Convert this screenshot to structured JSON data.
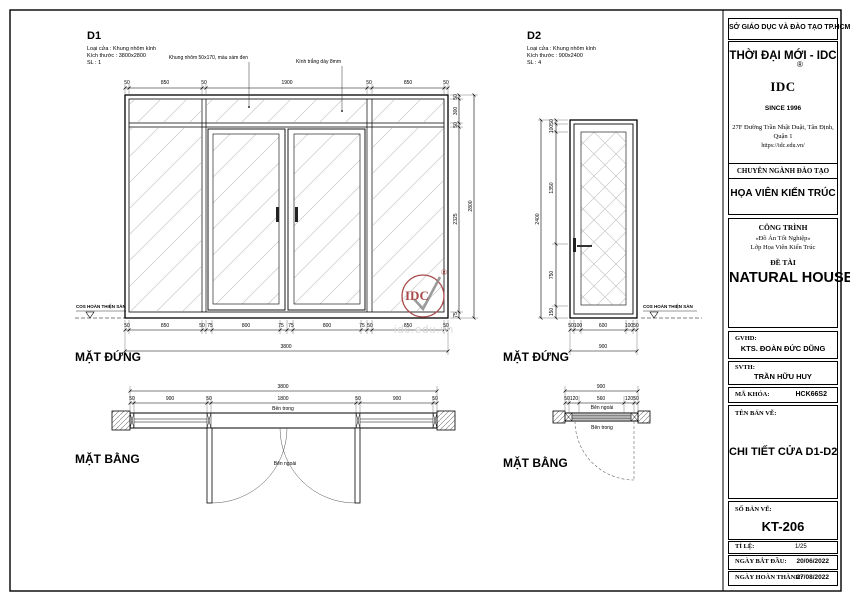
{
  "colors": {
    "stamp": "#a84a4a",
    "watermark": "#d9d9d9",
    "hatch": "#c8c8c8"
  },
  "watermark": "idc.edu.vn",
  "stamp": {
    "text": "IDC",
    "registered": "®"
  },
  "d1": {
    "code": "D1",
    "meta_type": "Loại cửa : Khung nhôm kính",
    "meta_size": "Kích thước : 3800x2800",
    "meta_qty": "SL : 1",
    "ann_frame": "Khung nhôm 50x170, màu xám đen",
    "ann_glass": "Kính trắng dày 8mm",
    "elevation_label": "MẶT ĐỨNG",
    "plan_label": "MẶT BẰNG",
    "floor_label": "COS HOÀN THIỆN SÀN",
    "inside": "Bên trong",
    "outside": "Bên ngoài",
    "dims": {
      "top": [
        "50",
        "850",
        "50",
        "1900",
        "50",
        "850",
        "50"
      ],
      "right": [
        "50",
        "300",
        "50",
        "2325",
        "75"
      ],
      "right_total": "2800",
      "bottom": [
        "50",
        "850",
        "50",
        "75",
        "800",
        "75",
        "75",
        "800",
        "75",
        "50",
        "850",
        "50"
      ],
      "bottom_total": "3800",
      "plan": [
        "50",
        "900",
        "50",
        "1800",
        "50",
        "900",
        "50"
      ],
      "plan_total": "3800"
    }
  },
  "d2": {
    "code": "D2",
    "meta_type": "Loại cửa : Khung nhôm kính",
    "meta_size": "Kích thước : 900x2400",
    "meta_qty": "SL : 4",
    "elevation_label": "MẶT ĐỨNG",
    "plan_label": "MẶT BẰNG",
    "floor_label": "COS HOÀN THIỆN SÀN",
    "inside": "Bên trong",
    "outside": "Bên ngoài",
    "dims": {
      "left": [
        "50",
        "100",
        "1350",
        "750",
        "150"
      ],
      "left_total": "2400",
      "bottom": [
        "50",
        "100",
        "600",
        "100",
        "50"
      ],
      "bottom_total": "900",
      "plan": [
        "50",
        "120",
        "560",
        "120",
        "50"
      ],
      "plan_total": "900"
    }
  },
  "titleblock": {
    "agency": "SỞ GIÁO DỤC VÀ ĐÀO TẠO TP.HCM",
    "brand": "THỜI ĐẠI MỚI - IDC",
    "logo_text": "IDC",
    "registered": "®",
    "since": "SINCE 1996",
    "address": "27F Đường Trần Nhật Duật, Tân Định,",
    "address2": "Quận 1",
    "website": "https://idc.edu.vn/",
    "training_header": "CHUYÊN NGÀNH ĐÀO TẠO",
    "major": "HỌA VIÊN KIẾN TRÚC",
    "project_header": "CÔNG TRÌNH",
    "project_line1": "«Đồ Án Tốt Nghiệp»",
    "project_line2": "Lớp Họa Viên Kiến Trúc",
    "topic_header": "ĐỀ TÀI",
    "project_title": "NATURAL HOUSE",
    "gvhd_label": "GVHD:",
    "gvhd": "KTS. ĐOÀN ĐỨC DŨNG",
    "svth_label": "SVTH:",
    "svth": "TRẦN HỮU HUY",
    "code_label": "MÃ KHÓA:",
    "code": "HCK66S2",
    "name_label": "TÊN BẢN VẼ:",
    "name": "CHI TIẾT CỬA D1-D2",
    "number_label": "SỐ BẢN VẼ:",
    "number": "KT-206",
    "scale_label": "TỈ LỆ:",
    "scale": "1/25",
    "start_label": "NGÀY BẮT ĐẦU:",
    "start": "20/06/2022",
    "finish_label": "NGÀY HOÀN THÀNH:",
    "finish": "27/08/2022"
  }
}
